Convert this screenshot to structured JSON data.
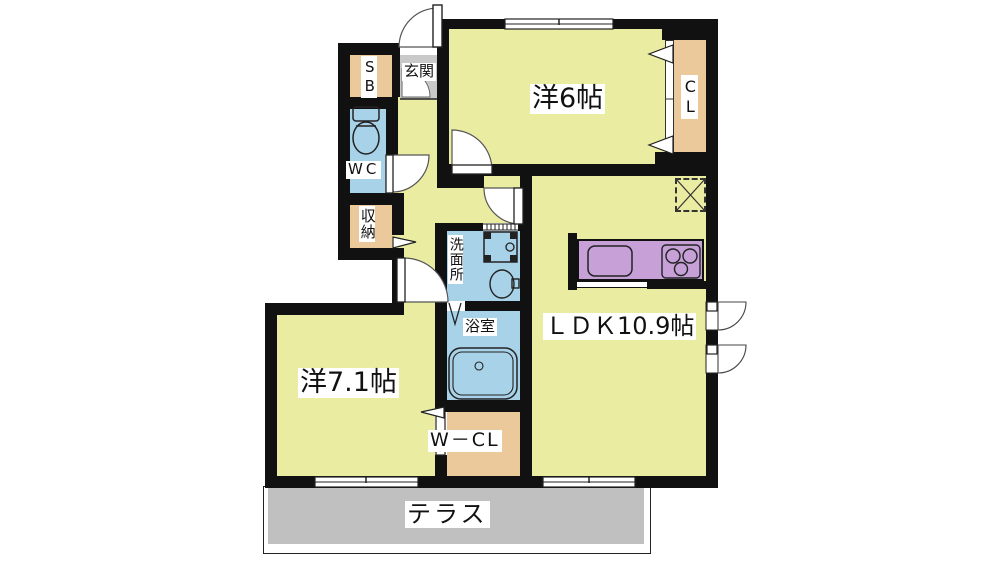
{
  "plan_title": "2LDK apartment floor plan",
  "colors": {
    "room_yellow": "#e9eca1",
    "wet_blue": "#a8d2e8",
    "closet_tan": "#ebc99b",
    "kitchen_purple": "#c7a0d8",
    "genkan_gray": "#c9c9c9",
    "terrace_gray": "#c0c0c0",
    "wall_black": "#111111",
    "label_bg": "#ffffff"
  },
  "rooms": {
    "western6": {
      "label": "洋6帖",
      "type": "western room, 6 tatami"
    },
    "cl": {
      "label": "CL",
      "type": "closet"
    },
    "sb": {
      "label": "SB",
      "type": "shoe box"
    },
    "genkan": {
      "label": "玄関",
      "type": "entrance"
    },
    "wc": {
      "label": "WC",
      "type": "toilet"
    },
    "storage": {
      "label": "収納",
      "type": "storage"
    },
    "washroom": {
      "label": "洗面所",
      "type": "washroom"
    },
    "bath": {
      "label": "浴室",
      "type": "bathroom"
    },
    "wcl": {
      "label": "W－CL",
      "type": "walk-in closet"
    },
    "ldk": {
      "label": "ＬＤＫ10.9帖",
      "type": "living dining kitchen, 10.9 tatami"
    },
    "western71": {
      "label": "洋7.1帖",
      "type": "western room, 7.1 tatami"
    },
    "terrace": {
      "label": "テラス",
      "type": "terrace"
    }
  }
}
